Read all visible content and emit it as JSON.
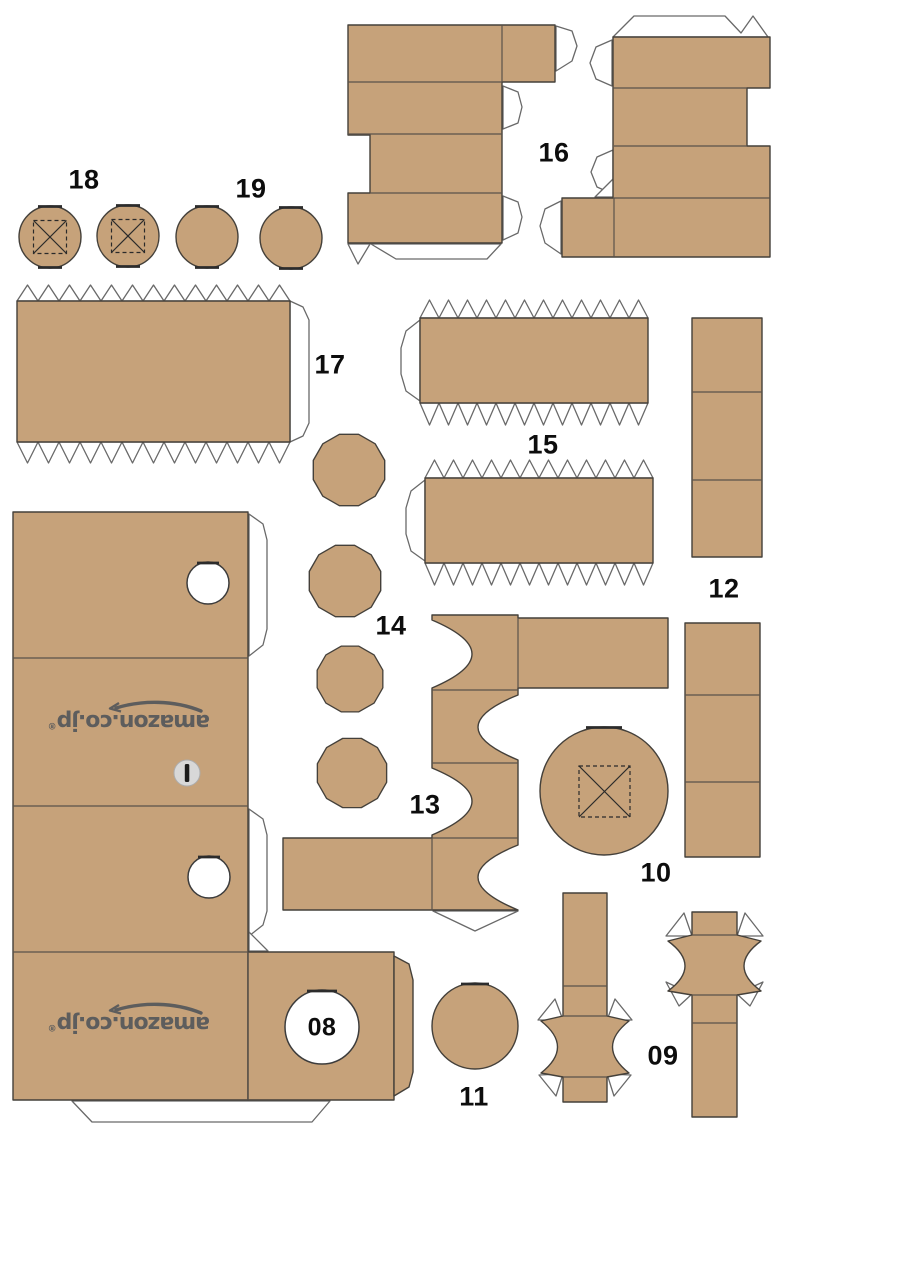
{
  "sheet": {
    "colors": {
      "background": "#ffffff",
      "cardboard": "#c6a27a",
      "outline": "#44403a",
      "fold_line": "#5a524a",
      "tab_fill": "#ffffff",
      "tab_stroke": "#696969",
      "label": "#0d0d0d",
      "logo_gray": "#5d5d5d",
      "hole_fill": "#ffffff",
      "slot_button": "#d8d8d8",
      "slot_bar": "#1c1c1c"
    },
    "logo": {
      "text": "amazon.co.jp",
      "registered": "®"
    },
    "labels": {
      "p08": "08",
      "p09": "09",
      "p10": "10",
      "p11": "11",
      "p12": "12",
      "p13": "13",
      "p14": "14",
      "p15": "15",
      "p16": "16",
      "p17": "17",
      "p18": "18",
      "p19": "19"
    }
  }
}
